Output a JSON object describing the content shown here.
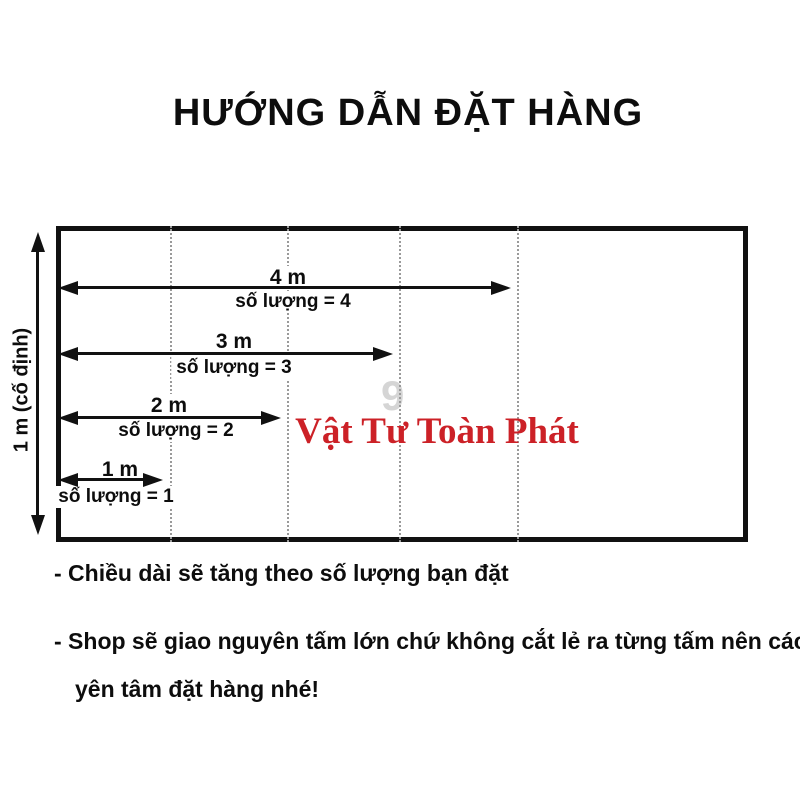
{
  "title": "HƯỚNG DẪN ĐẶT HÀNG",
  "diagram": {
    "height_label": "1 m (cố định)",
    "brand_watermark": "Vật Tư Toàn Phát",
    "ghost_digit": "9",
    "measurements": [
      {
        "length": "4 m",
        "quantity": "số lượng = 4"
      },
      {
        "length": "3 m",
        "quantity": "số lượng = 3"
      },
      {
        "length": "2 m",
        "quantity": "số lượng = 2"
      },
      {
        "length": "1 m",
        "quantity": "số lượng = 1"
      }
    ],
    "colors": {
      "line": "#111111",
      "dotted_line": "#9a9a9a",
      "brand_red": "#cc2127",
      "text": "#1a1a1a"
    }
  },
  "notes": {
    "line1": "- Chiều dài sẽ tăng theo số lượng bạn đặt",
    "line2": "- Shop sẽ giao nguyên tấm lớn chứ không cắt lẻ ra từng tấm nên các bạn",
    "line3": "yên tâm đặt hàng nhé!"
  }
}
